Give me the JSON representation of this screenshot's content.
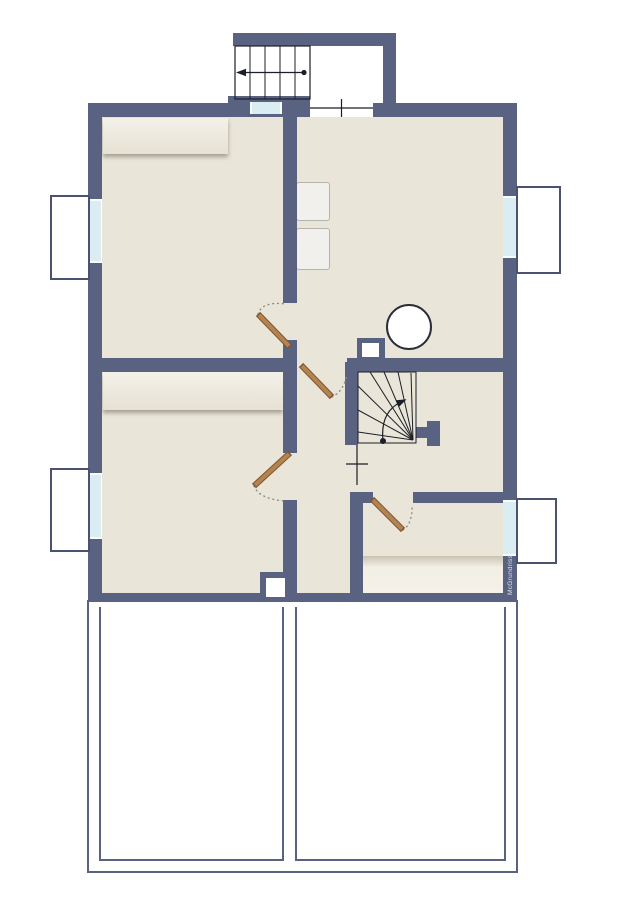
{
  "watermark": {
    "text": "McGrundriss"
  },
  "colors": {
    "wall": "#5a6282",
    "floor": "#e9e5d9",
    "line": "#1c1f28",
    "glass": "#d9edf3",
    "glass_cap": "#f7fcfe",
    "lightwell_border": "#4a5270",
    "door_leaf": "#b5834f",
    "door_edge": "#7e5730",
    "arc": "#8b8b8b",
    "furniture_hi": "#f4f1e9",
    "furniture_lo": "#e6e1d3",
    "appliance_fill": "#f1f0ed",
    "appliance_border": "#b5b3ae",
    "terrace": "#5a6282",
    "bg": "#ffffff",
    "watermark": "#dfe1e8"
  }
}
